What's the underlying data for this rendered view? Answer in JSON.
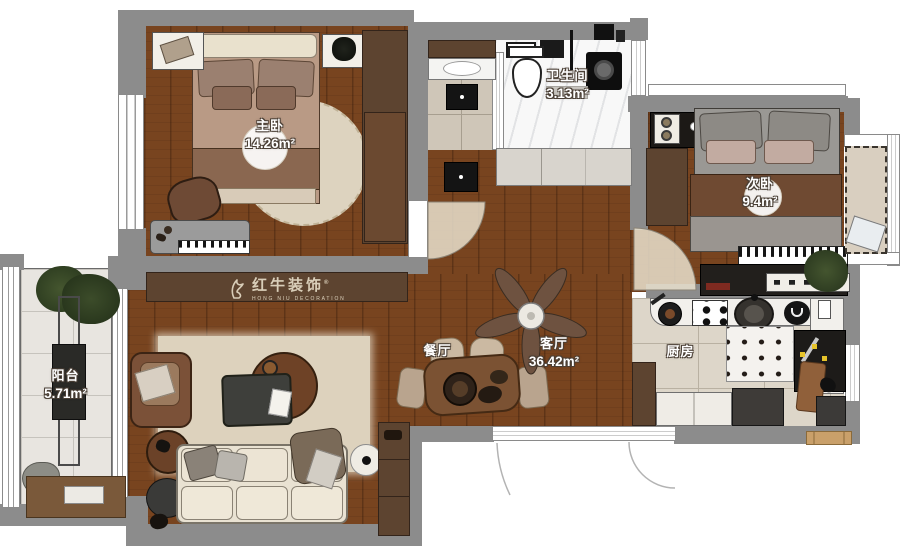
{
  "watermark": {
    "brand": "红牛装饰",
    "subtitle": "HONG NIU DECORATION",
    "registered": "®"
  },
  "rooms": {
    "master_bedroom": {
      "label": "主卧",
      "area": "14.26m²"
    },
    "bathroom": {
      "label": "卫生间",
      "area": "3.13m²"
    },
    "second_bedroom": {
      "label": "次卧",
      "area": "9.4m²"
    },
    "balcony": {
      "label": "阳台",
      "area": "5.71m²"
    },
    "dining": {
      "label": "餐厅",
      "area": ""
    },
    "living": {
      "label": "客厅",
      "area": "36.42m²"
    },
    "kitchen": {
      "label": "厨房",
      "area": ""
    }
  },
  "colors": {
    "wall": "#8c8c8c",
    "wood_floor": "#78441f",
    "balcony_tile": "#e8e5e0",
    "kitchen_tile": "#ddd6c9",
    "hall_tile": "#cfc6b8",
    "bath_floor": "#f8f8f8",
    "cabinet_wood": "#5d4430",
    "label_text": "#ffffff",
    "label_outline": "#4a3f35"
  }
}
